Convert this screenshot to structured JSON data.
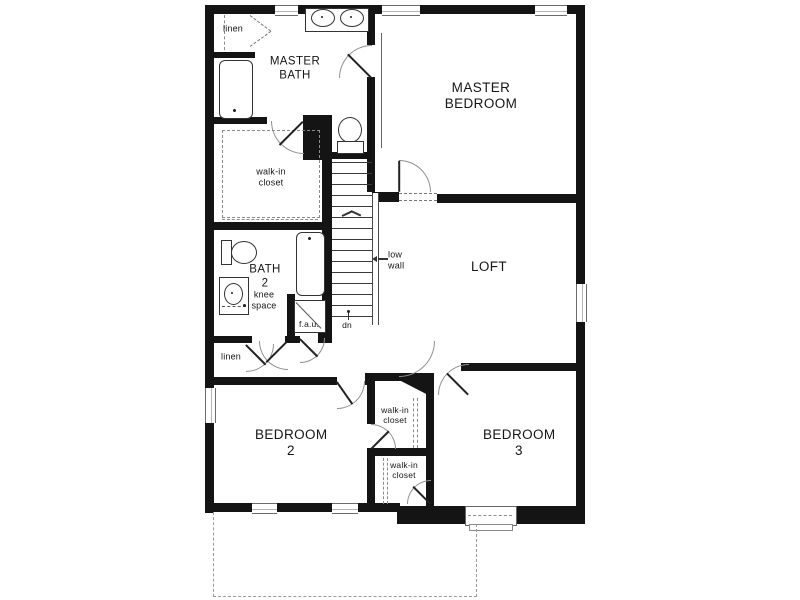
{
  "floor_plan": {
    "labels": {
      "linen_top": "linen",
      "master_bath": "MASTER BATH",
      "master_bedroom": "MASTER BEDROOM",
      "master_closet": "walk-in closet",
      "bath_2": "BATH 2",
      "knee_space": "knee space",
      "fau": "f.a.u.",
      "stairs_dn": "dn",
      "low_wall": "low wall",
      "loft": "LOFT",
      "linen_hall": "linen",
      "bedroom_2": "BEDROOM 2",
      "bedroom_3": "BEDROOM 3",
      "closet_bedroom2": "walk-in closet",
      "closet_bedroom3": "walk-in closet"
    },
    "palette": {
      "wall_color": "#141414",
      "line_color": "#333333",
      "dashed_color": "#8c8c8c",
      "background": "#ffffff"
    }
  }
}
